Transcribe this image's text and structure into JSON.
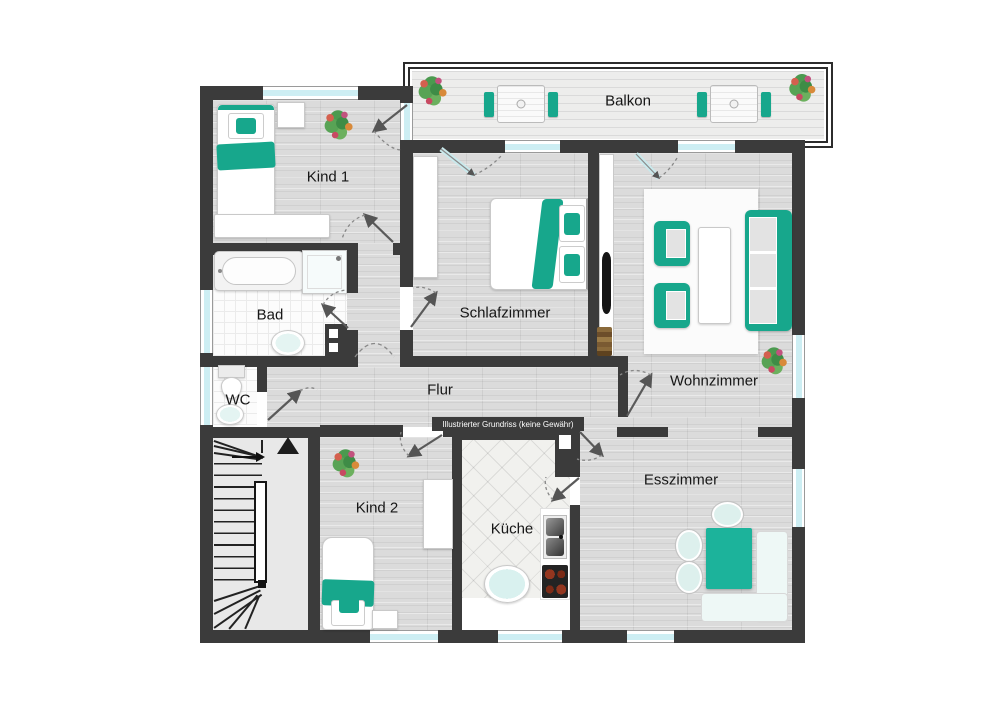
{
  "plan": {
    "watermark": "Illustrierter Grundriss (keine Gewähr)",
    "rooms": {
      "balkon": "Balkon",
      "kind1": "Kind 1",
      "schlafzimmer": "Schlafzimmer",
      "wohnzimmer": "Wohnzimmer",
      "bad": "Bad",
      "wc": "WC",
      "flur": "Flur",
      "kind2": "Kind 2",
      "kueche": "Küche",
      "esszimmer": "Esszimmer"
    },
    "colors": {
      "wall": "#3b3b3b",
      "accent_teal": "#17a78c",
      "window_glass": "#cdeef3",
      "floor_wood": "#dbdbdb"
    },
    "symbols": {
      "stairs_direction": "up",
      "entrance_marker": "triangle-up"
    }
  }
}
